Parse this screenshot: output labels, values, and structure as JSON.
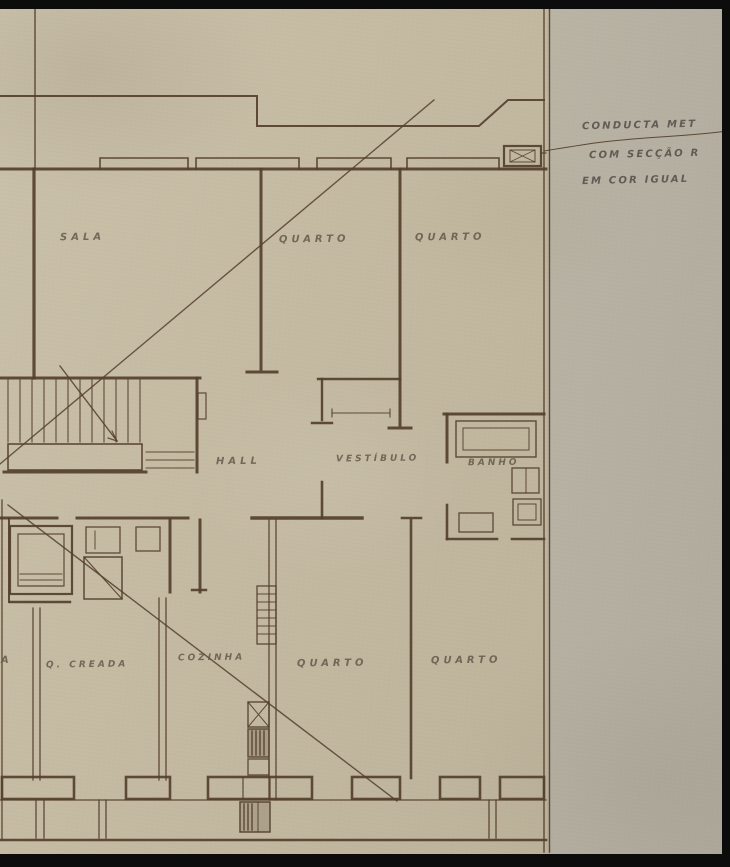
{
  "rooms": {
    "sala": "SALA",
    "quarto_top_1": "QUARTO",
    "quarto_top_2": "QUARTO",
    "hall": "HALL",
    "vestibulo": "VESTÍBULO",
    "banho": "BANHO",
    "creada": "Q. CREADA",
    "cozinha": "COZINHA",
    "quarto_bottom_1": "QUARTO",
    "quarto_bottom_2": "QUARTO",
    "edge_fragment": "A"
  },
  "annotation": {
    "line1": "CONDUCTA MET",
    "line2": "COM SECÇÃO R",
    "line3": "EM COR IGUAL"
  },
  "colors": {
    "paper_left": "#c6bca4",
    "paper_right": "#b3aea0",
    "ink": "#54402d",
    "frame": "#0c0c0c",
    "label_ink": "#5f5748"
  }
}
